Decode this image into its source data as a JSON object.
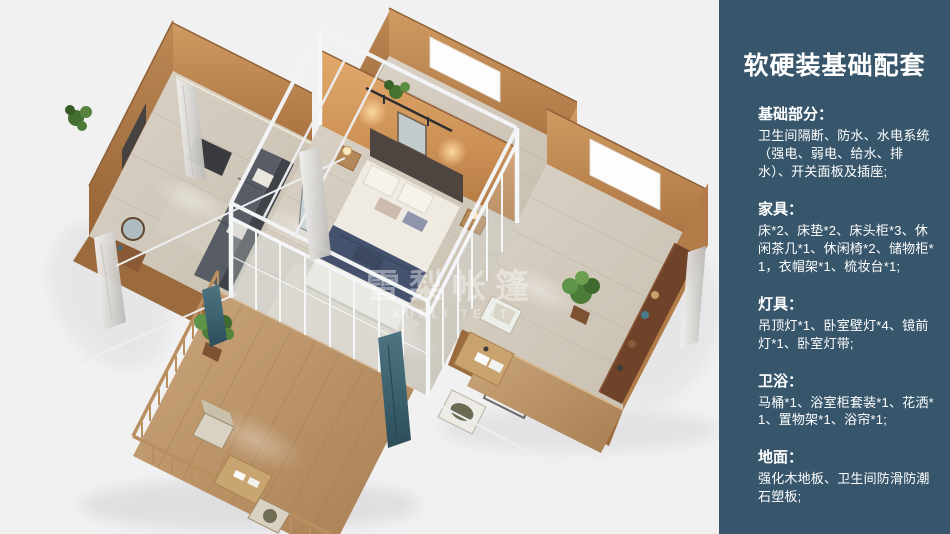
{
  "scene": {
    "watermark_cn": "雪梨帐篷",
    "watermark_en": "XUELI TENT"
  },
  "sidebar": {
    "bg_color": "#37566b",
    "title": "软硬装基础配套",
    "sections": [
      {
        "heading": "基础部分：",
        "body": "卫生间隔断、防水、水电系统（强电、弱电、给水、排水）、开关面板及插座;"
      },
      {
        "heading": "家具：",
        "body": "床*2、床垫*2、床头柜*3、休闲茶几*1、休闲椅*2、储物柜*1，衣帽架*1、梳妆台*1;"
      },
      {
        "heading": "灯具：",
        "body": "吊顶灯*1、卧室壁灯*4、镜前灯*1、卧室灯带;"
      },
      {
        "heading": "卫浴：",
        "body": "马桶*1、浴室柜套装*1、花洒*1、置物架*1、浴帘*1;"
      },
      {
        "heading": "地面：",
        "body": "强化木地板、卫生间防滑防潮石塑板;"
      }
    ]
  }
}
